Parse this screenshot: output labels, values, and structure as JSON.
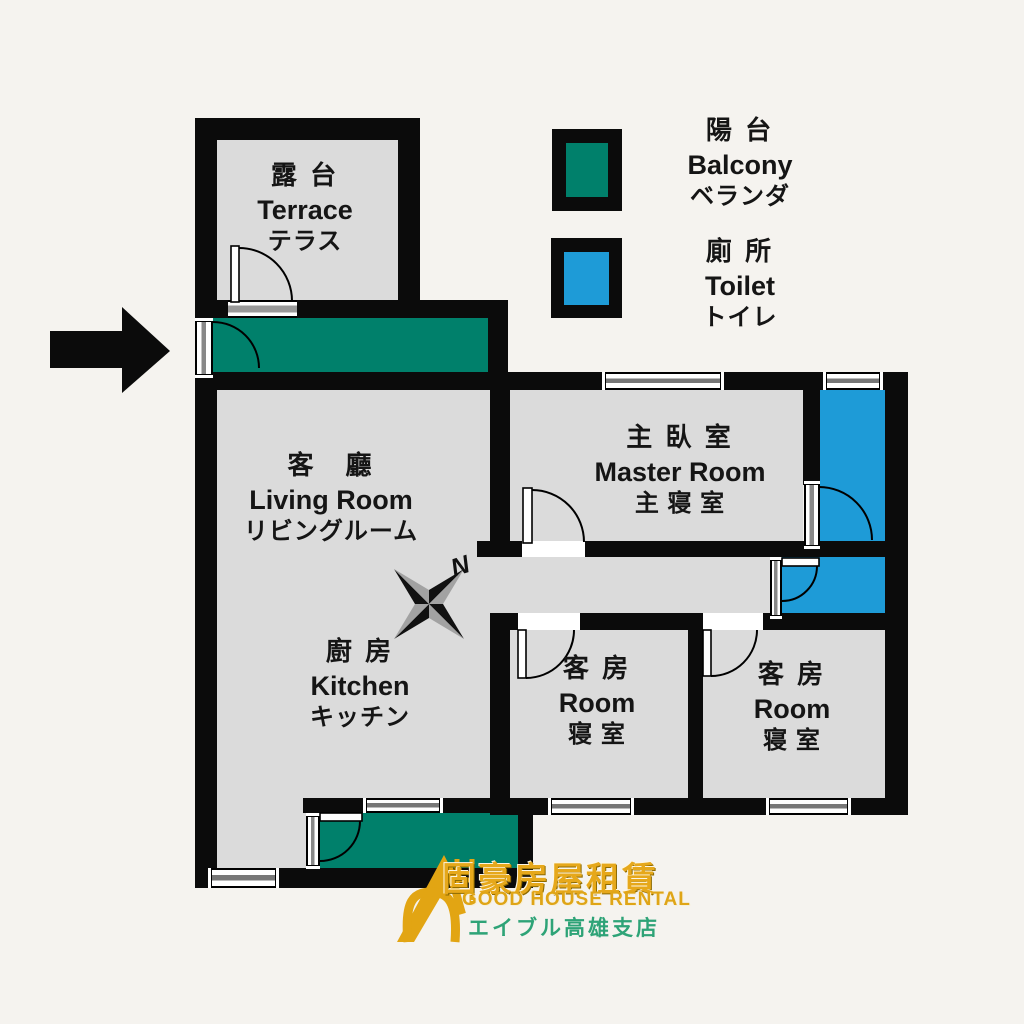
{
  "plan_title": "apartment-floor-plan",
  "colors": {
    "background": "#f5f3ef",
    "wall": "#0b0b0b",
    "floor_gray": "#dbdbdb",
    "balcony_green": "#00806b",
    "toilet_blue": "#1e9bd7",
    "logo_gold": "#e6a81b",
    "logo_green": "#2ea377"
  },
  "rooms": {
    "terrace": {
      "zh": "露 台",
      "en": "Terrace",
      "ja": "テラス"
    },
    "living": {
      "zh": "客　廳",
      "en": "Living Room",
      "ja": "リビングルーム"
    },
    "kitchen": {
      "zh": "廚 房",
      "en": "Kitchen",
      "ja": "キッチン"
    },
    "master": {
      "zh": "主 臥 室",
      "en": "Master Room",
      "ja": "主 寝 室"
    },
    "room1": {
      "zh": "客 房",
      "en": "Room",
      "ja": "寝 室"
    },
    "room2": {
      "zh": "客 房",
      "en": "Room",
      "ja": "寝 室"
    }
  },
  "legend": {
    "balcony": {
      "zh": "陽 台",
      "en": "Balcony",
      "ja": "ベランダ",
      "color": "#00806b"
    },
    "toilet": {
      "zh": "廁 所",
      "en": "Toilet",
      "ja": "トイレ",
      "color": "#1e9bd7"
    }
  },
  "compass": {
    "north_label": "N"
  },
  "logo": {
    "zh": "固豪房屋租賃",
    "en": "GOOD HOUSE RENTAL",
    "ja": "エイブル高雄支店"
  },
  "icons": {
    "compass": "compass-rose-icon",
    "entrance_arrow": "entrance-arrow-icon",
    "logo_house": "house-logo-icon"
  }
}
